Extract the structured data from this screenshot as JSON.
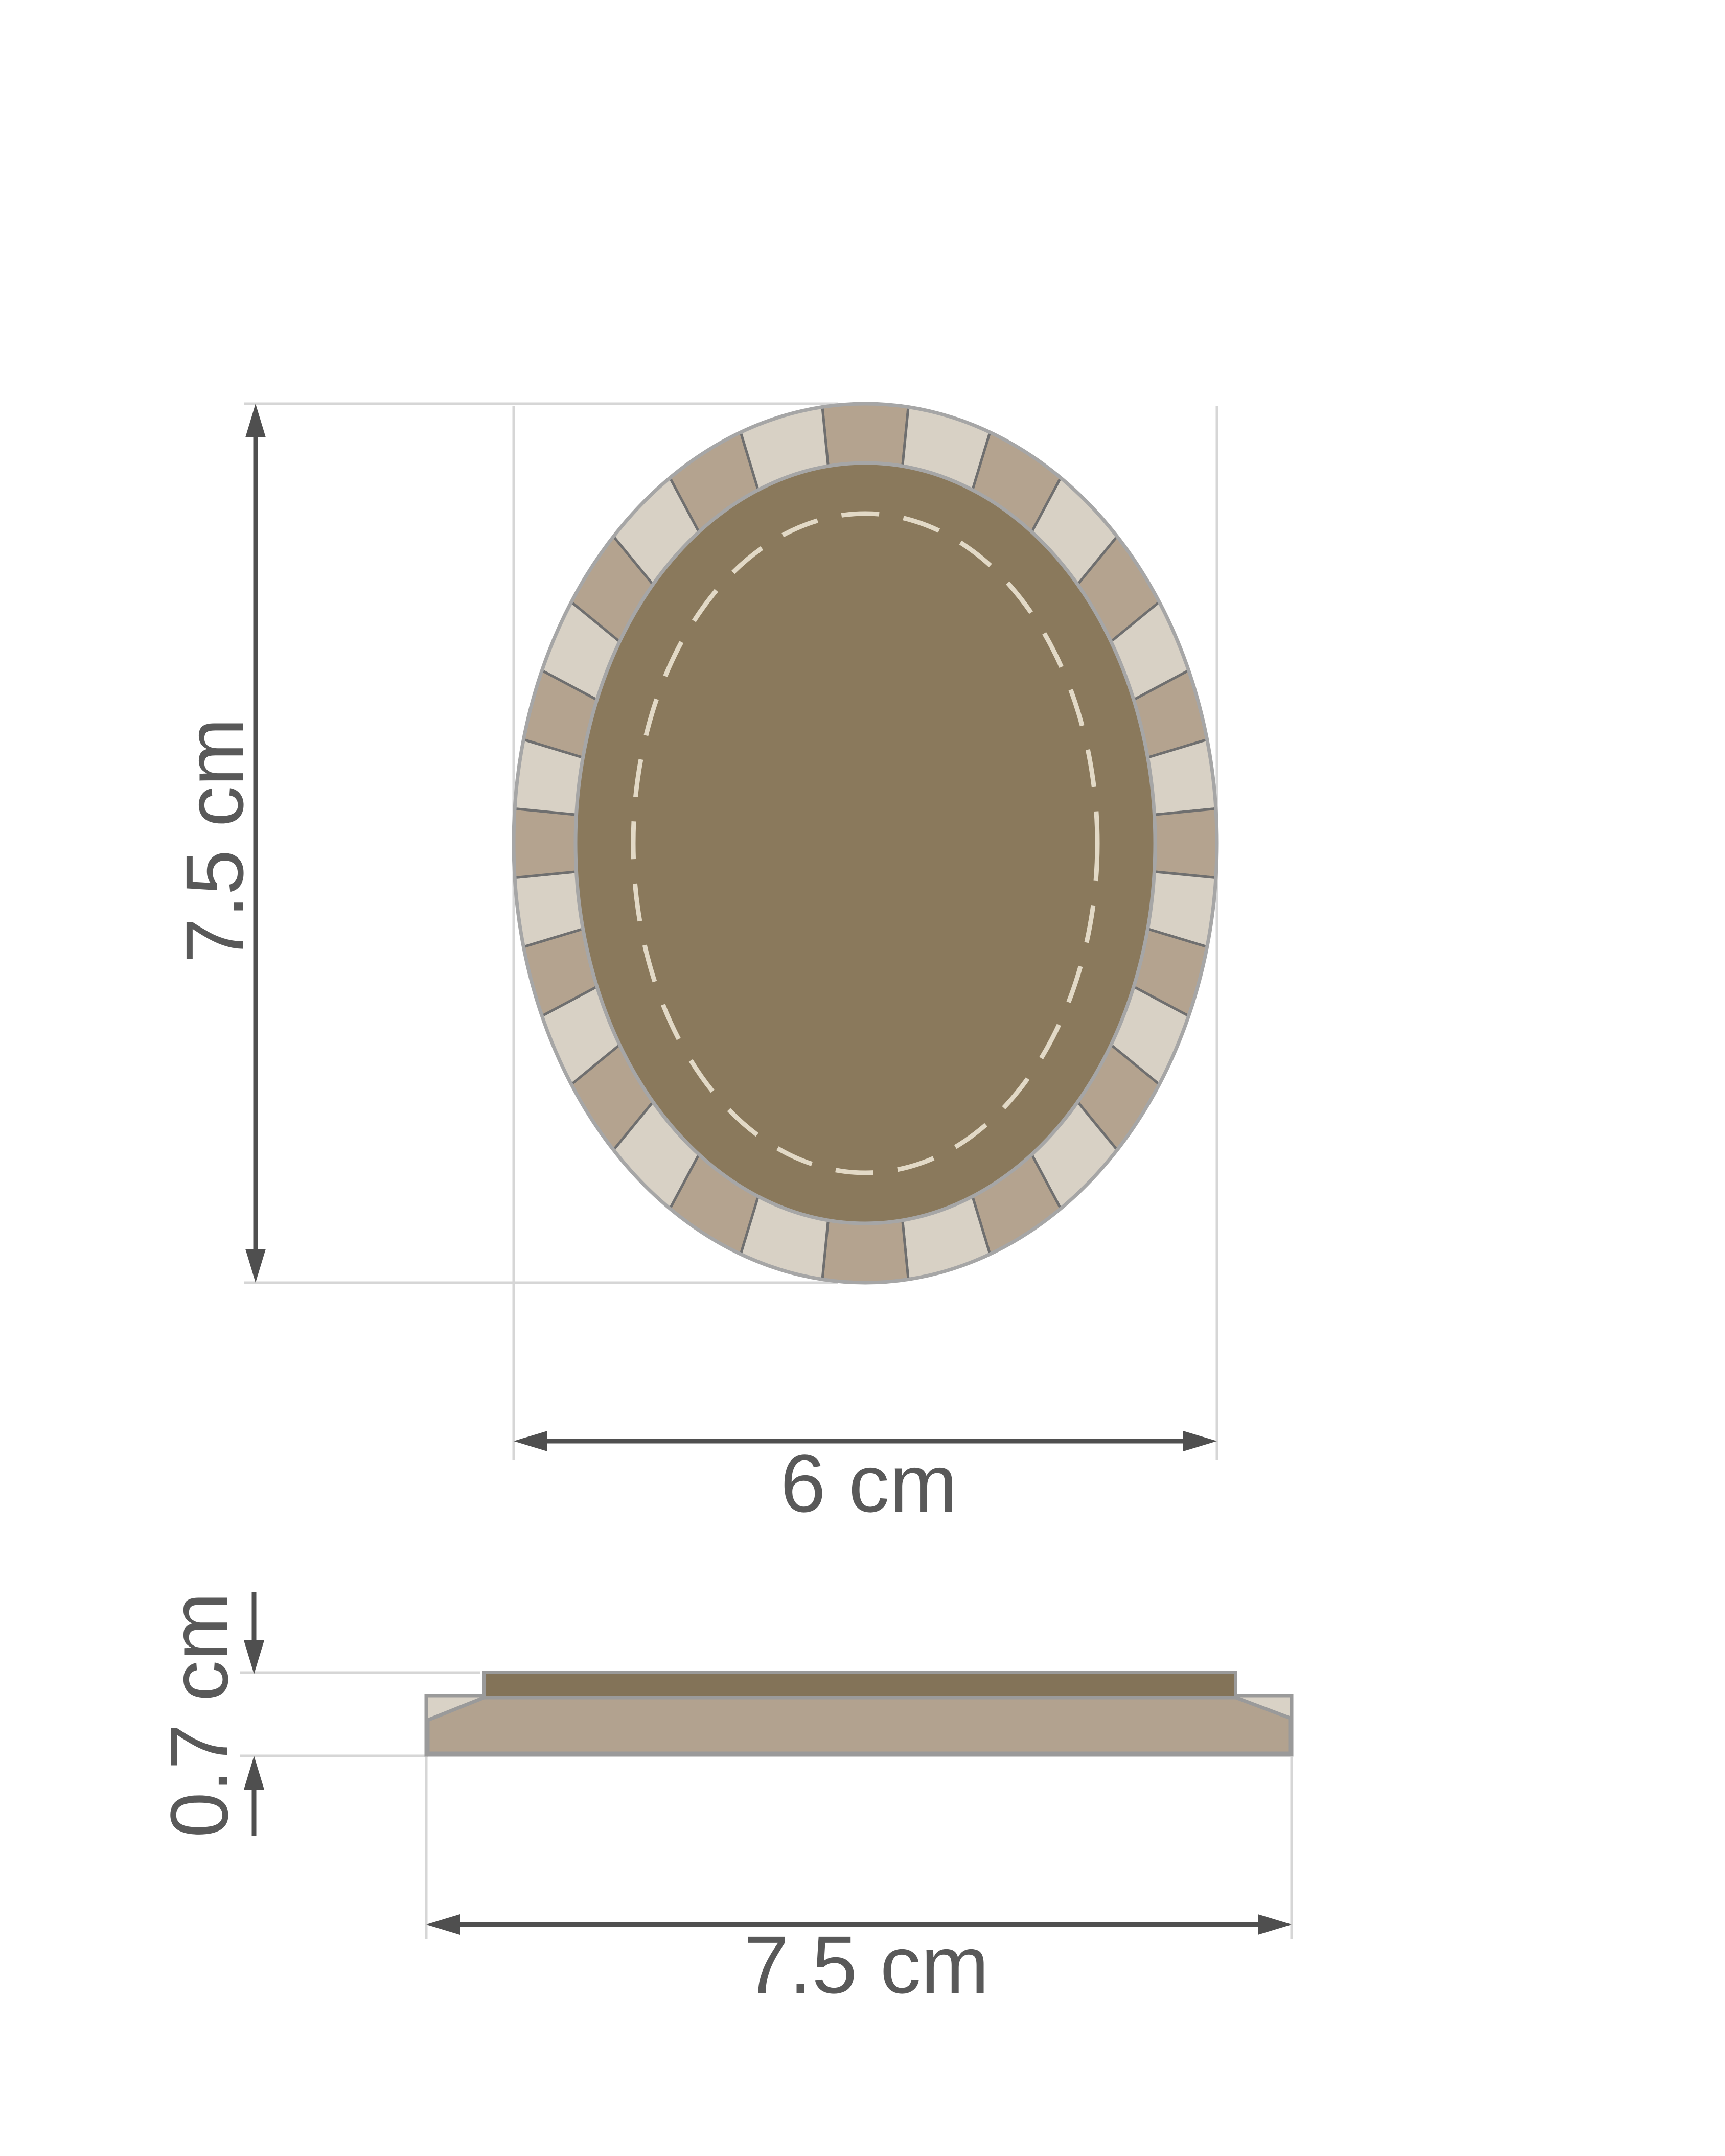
{
  "labels": {
    "oval_height": "7.5 cm",
    "oval_width": "6 cm",
    "profile_thickness": "0.7 cm",
    "profile_width": "7.5 cm"
  },
  "ring": {
    "segment_count": 32,
    "tan_color": "#b4a38f",
    "cream_color": "#d8d1c5",
    "divider_color": "#6f6f6f"
  },
  "colors": {
    "background": "#ffffff",
    "pad_dark": "#8a795c",
    "rim_outline": "#a6a6a6",
    "dashed_stitch": "#e2d9c6",
    "dimension_line": "#4f4f4f",
    "label_text": "#595959",
    "extension_line": "#d6d6d6",
    "profile_strip_dark": "#837358",
    "profile_slab_tan": "#b2a28f",
    "profile_bevel_cream": "#d9d2c6",
    "profile_outline": "#9a9a9a"
  }
}
